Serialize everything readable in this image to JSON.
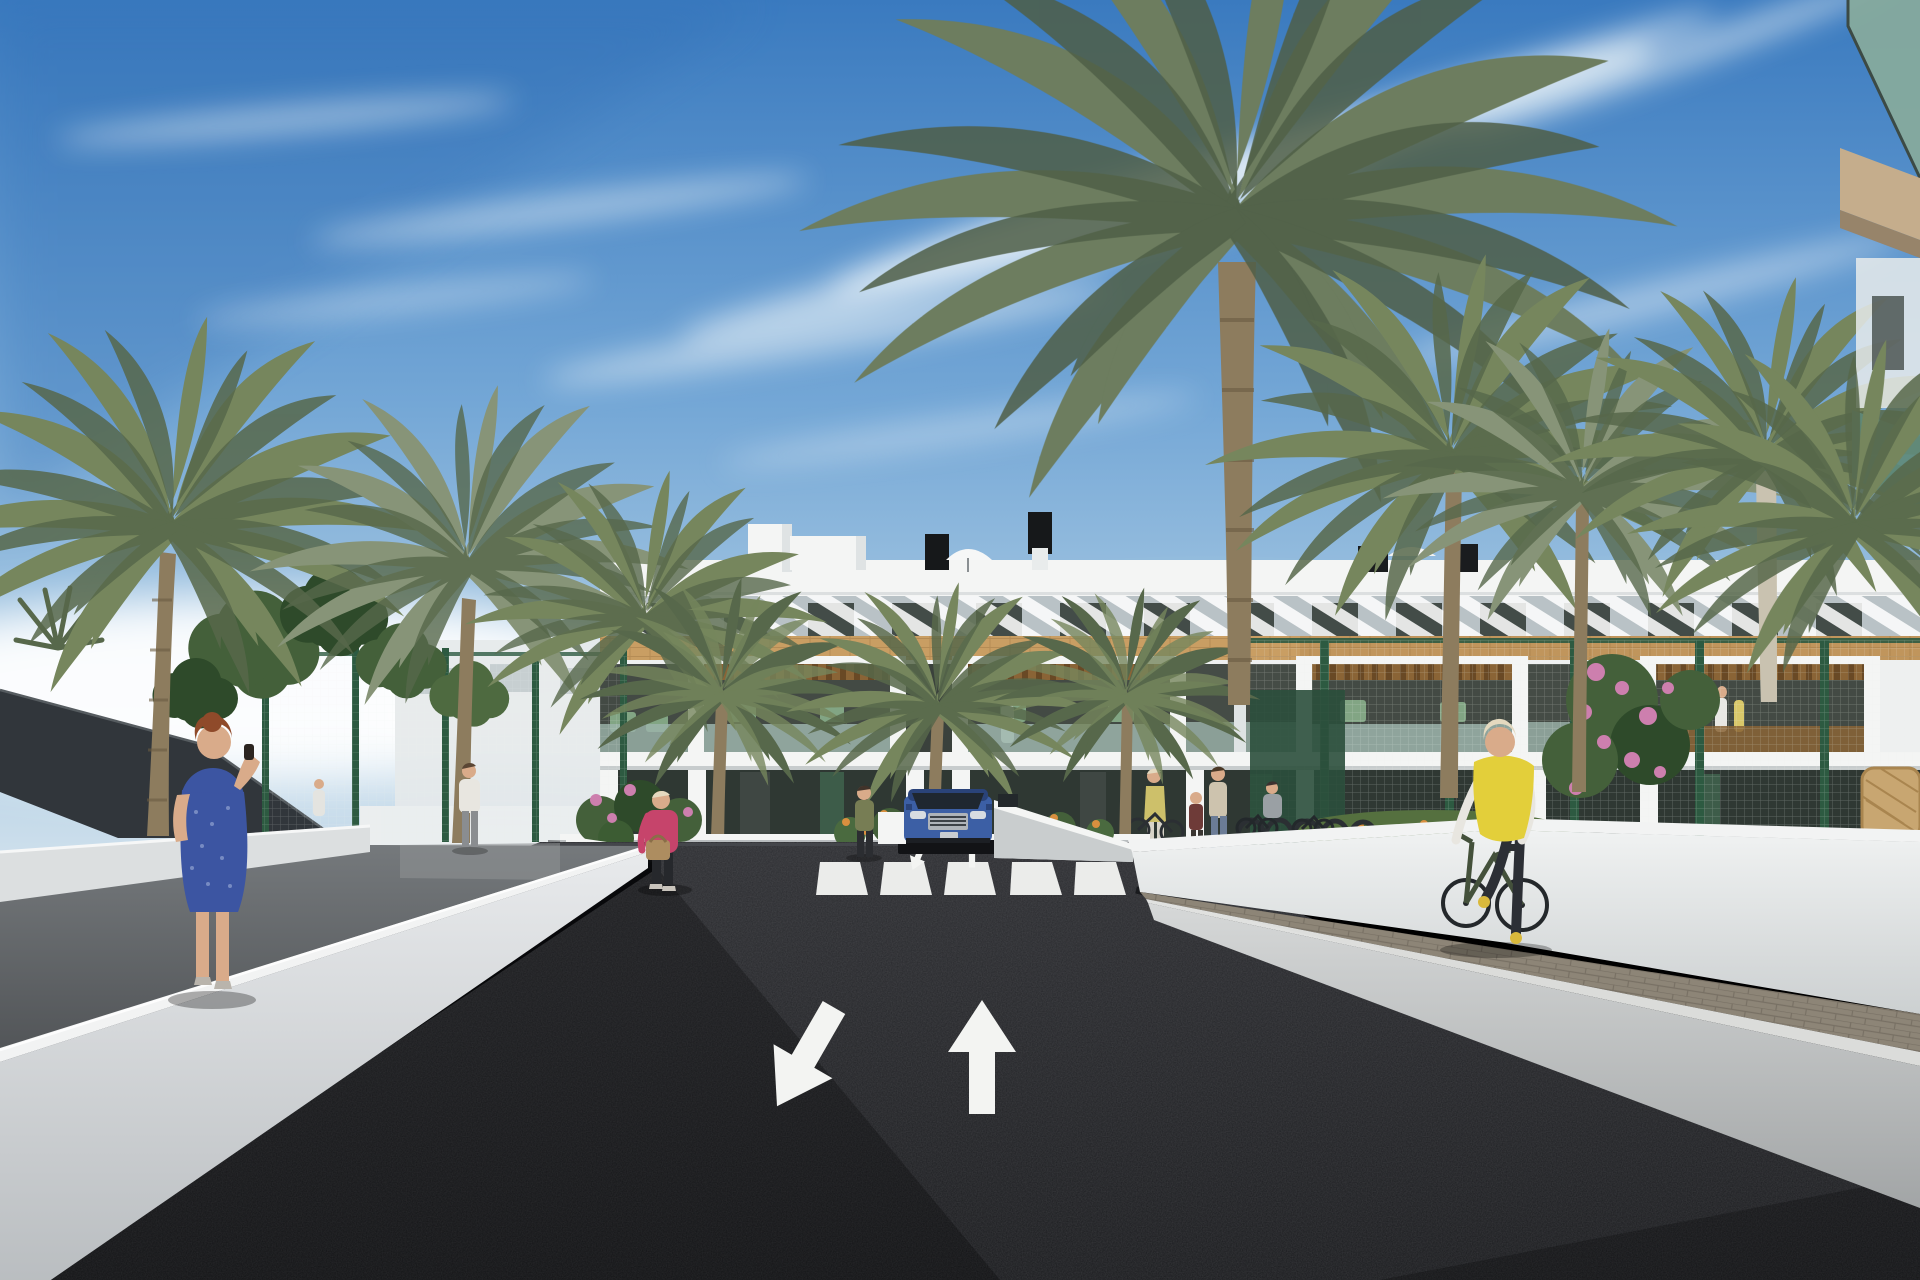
{
  "scene": {
    "description": "Sunny 3D architectural rendering of a modern white three-storey apartment complex lined with palm trees. A new black asphalt access road with two painted lane arrows and a zebra crossing leads to the building, where a blue SUV exits an underground car park. A red-haired woman in a blue dress walks on the left walkway talking on her phone, a woman in a pink jacket crosses near the gardens, pedestrians gather by bike racks on the right, and a woman in a yellow vest cycles away along the right sidewalk.",
    "time_of_day": "day",
    "sky": "blue with thin diagonal clouds and white haze at the horizon",
    "buildings": {
      "main": "white apartment block with rooftop terraces, diagonal white brise-soleil slats, travertine stone band, wood pergola terraces and glass balustrades",
      "foreground_right": "corner of a foreground apartment building with green-tinted glass balcony"
    },
    "road": {
      "surface": "fresh dark asphalt",
      "crosswalk_stripes": 5,
      "lane_arrows": [
        "oncoming-down-left",
        "forward-up"
      ],
      "small_arrows": 2
    },
    "vehicle": "blue SUV exiting the underground parking ramp",
    "people": [
      "red-haired woman in blue dress on phone (left walkway)",
      "man in white shirt walking (left path)",
      "distant pedestrian (left path)",
      "blonde woman in pink jacket with handbag (center pavement)",
      "woman standing near the ramp (center)",
      "woman in yellow top walking a bicycle (right pavement)",
      "child (right pavement)",
      "woman in beige top and jeans (right pavement)",
      "seated woman (right pavement)",
      "woman on terrace (building)",
      "two residents on far-right terrace",
      "cyclist in yellow vest riding away (right sidewalk)"
    ],
    "street_furniture": [
      "bike racks with bicycles",
      "green mesh fence",
      "dark shade sail",
      "wicker chair",
      "rooftop parasols",
      "black chimneys"
    ],
    "vegetation": {
      "palm_trees": 10,
      "round_trees": 6,
      "flowers": [
        "pink",
        "orange"
      ]
    }
  },
  "colors": {
    "sky_top": "#3a7abf",
    "sky_mid": "#74a7d6",
    "sky_low": "#aecde4",
    "sky_horizon": "#d6e4ee",
    "cloud_white": "#f2f7fa",
    "building_white": "#f4f5f4",
    "building_shade": "#dfe3e4",
    "slat_gray": "#b9c2c6",
    "travertine": "#c99e63",
    "travertine_dark": "#a87d46",
    "wood": "#8a6436",
    "glazing_dark": "#2f3833",
    "terrace_shadow": "#434a44",
    "glass_green": "#9cb4ab",
    "door_green": "#3d5c49",
    "palm_green": "#76865d",
    "palm_dark": "#57684b",
    "palm_gray": "#879478",
    "palm_trunk": "#8d7c5e",
    "trunk_dark": "#6b5c42",
    "trunk_pale": "#c9c2b0",
    "tree_green": "#44603a",
    "tree_dark": "#2e4a2a",
    "fence_green": "#2d5a41",
    "sail_gray": "#31363b",
    "asphalt_top": "#2c2d31",
    "asphalt_bottom": "#191a1d",
    "road_marking": "#f3f4f2",
    "wall_top": "#f2f3f3",
    "wall_face": "#dcdfe0",
    "walkway_gray": "#63676a",
    "pavement": "#cfd2d2",
    "brick_strip": "#8d8577",
    "car_blue": "#3c5fa5",
    "car_blue_dark": "#2a4379",
    "vest_yellow": "#e3cf3a",
    "dress_blue": "#3c55a2",
    "jacket_pink": "#c6446b",
    "skin": "#d9ab8a",
    "hair_red": "#8f4a2a",
    "hair_blonde": "#e4d9bf",
    "shirt_white": "#e8e6e0",
    "jeans_blue": "#6b7c96",
    "flower_pink": "#cd7fae",
    "flower_orange": "#d98f3f"
  }
}
